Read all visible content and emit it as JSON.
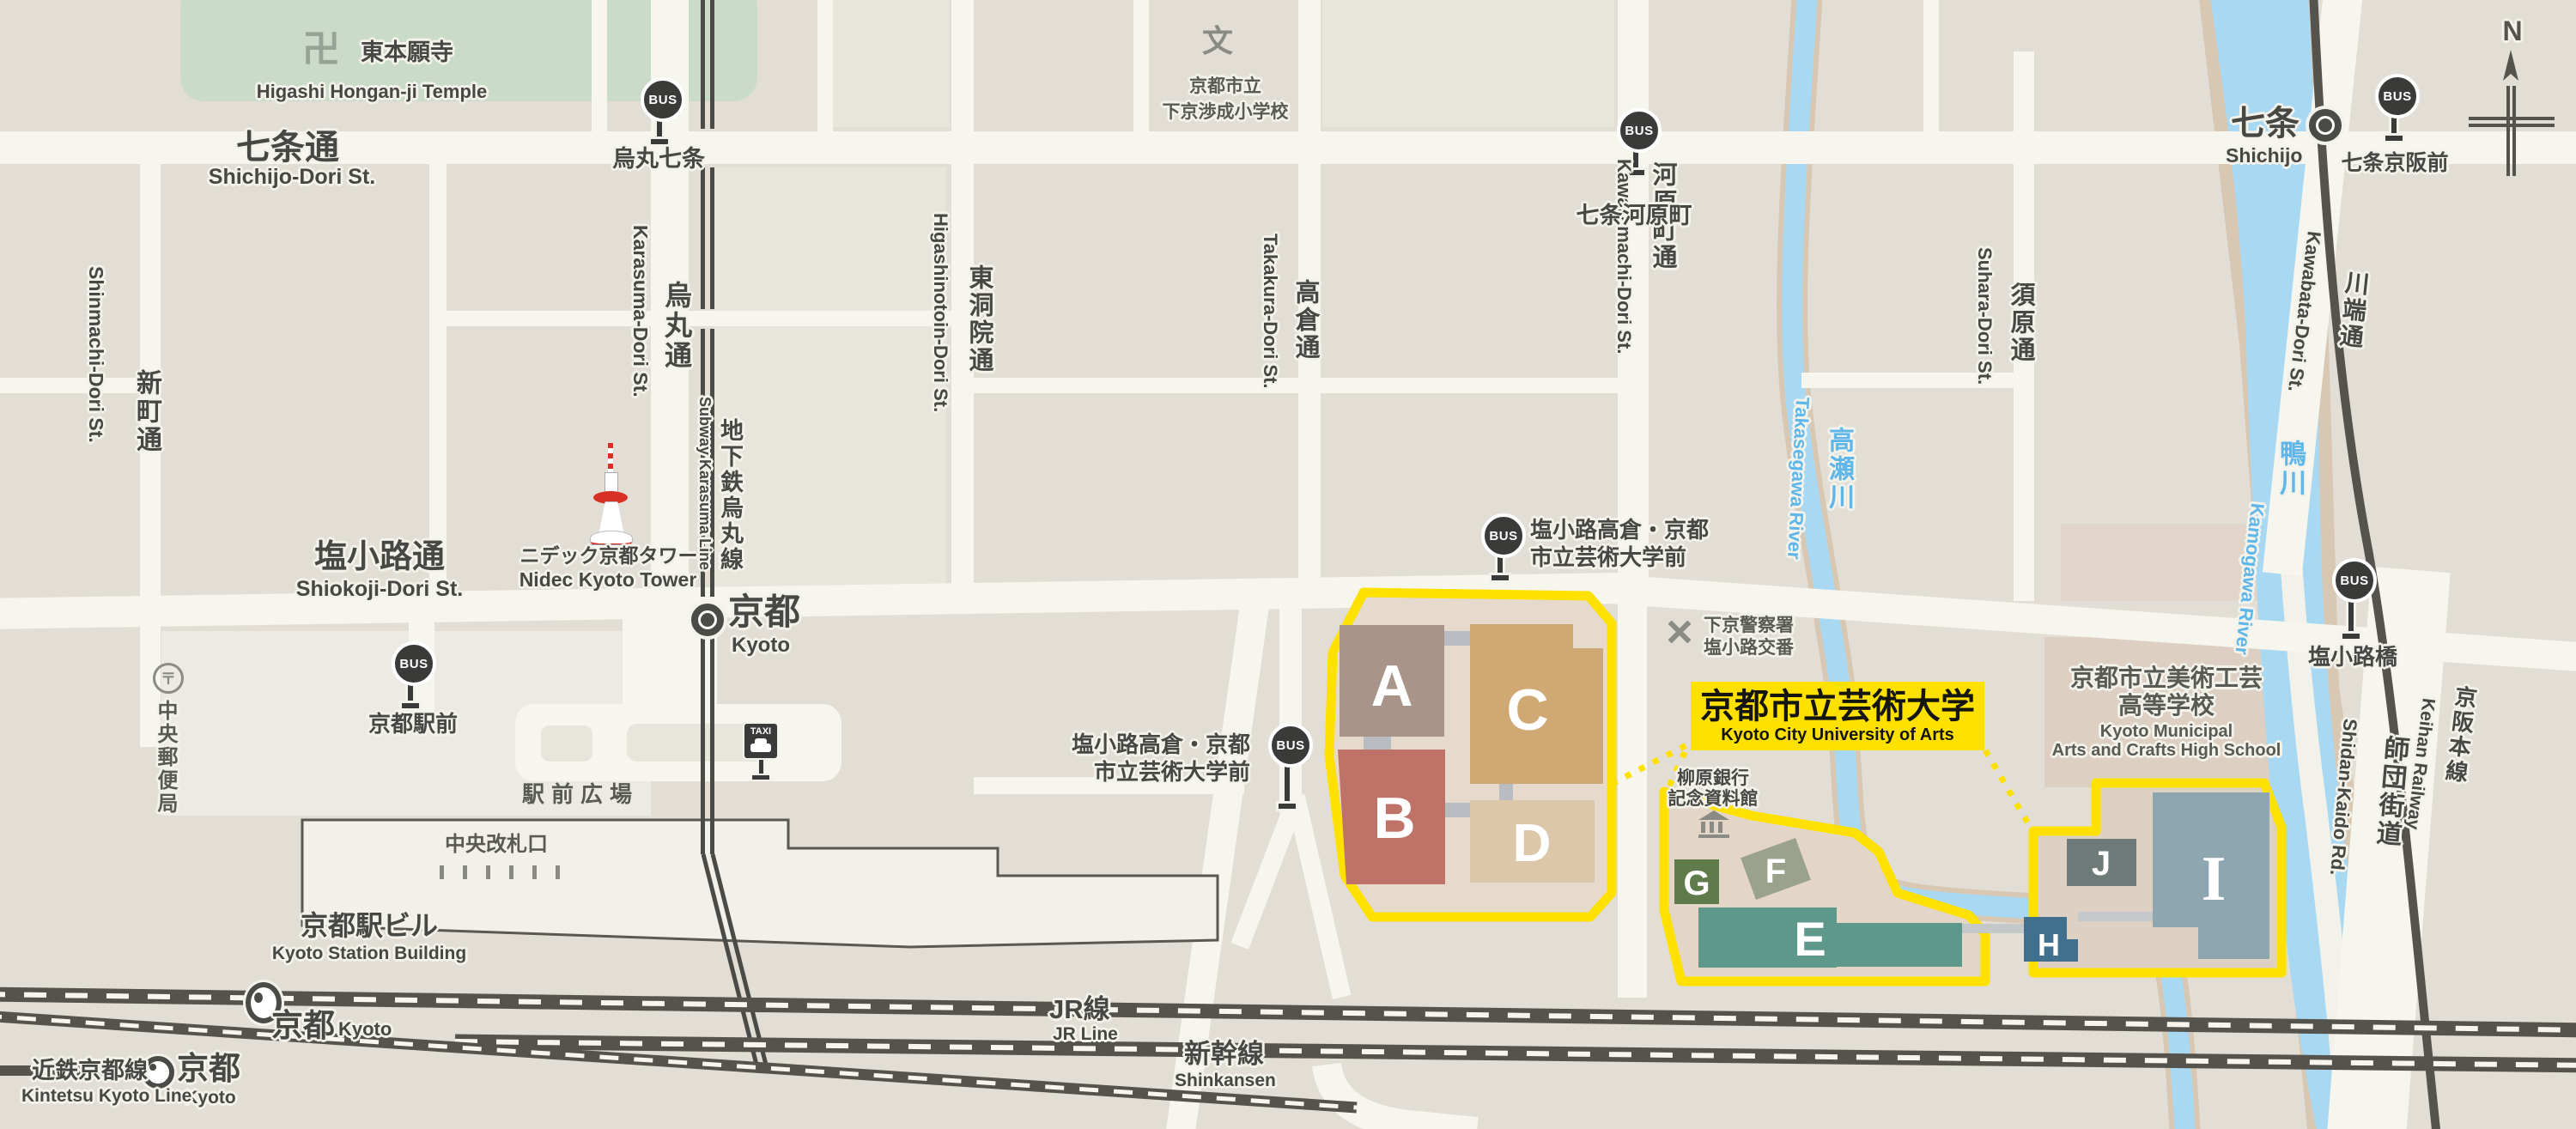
{
  "map": {
    "compass_n": "N",
    "bus_badge": "BUS",
    "taxi_badge": "TAXI"
  },
  "temple": {
    "icon": "卍",
    "ja": "東本願寺",
    "en": "Higashi Hongan-ji Temple"
  },
  "elementary_school": {
    "icon": "文",
    "ja1": "京都市立",
    "ja2": "下京渉成小学校"
  },
  "streets": {
    "shichijo": {
      "ja": "七条通",
      "en": "Shichijo-Dori St."
    },
    "shiokoji": {
      "ja": "塩小路通",
      "en": "Shiokoji-Dori St."
    },
    "shinmachi": {
      "ja": "新町通",
      "en": "Shinmachi-Dori St."
    },
    "karasuma": {
      "ja": "烏丸通",
      "en": "Karasuma-Dori St."
    },
    "higashinotoin": {
      "ja": "東洞院通",
      "en": "Higashinotoin-Dori St."
    },
    "takakura": {
      "ja": "高倉通",
      "en": "Takakura-Dori St."
    },
    "kawaramachi": {
      "ja": "河原町通",
      "en": "Kawaramachi-Dori St."
    },
    "suhara": {
      "ja": "須原通",
      "en": "Suhara-Dori St."
    },
    "kawabata": {
      "ja": "川端通",
      "en": "Kawabata-Dori St."
    },
    "shidankaido": {
      "ja": "師団街道",
      "en": "Shidan-Kaido Rd."
    }
  },
  "railways": {
    "subway": {
      "ja": "地下鉄烏丸線",
      "en": "Subway Karasuma Line"
    },
    "jr": {
      "ja": "JR線",
      "en": "JR Line"
    },
    "shinkansen": {
      "ja": "新幹線",
      "en": "Shinkansen"
    },
    "kintetsu": {
      "ja": "近鉄京都線",
      "en": "Kintetsu Kyoto Line"
    },
    "keihan": {
      "ja": "京阪本線",
      "en": "Keihan Railway"
    }
  },
  "rivers": {
    "takasegawa": {
      "ja": "高瀬川",
      "en": "Takasegawa River"
    },
    "kamogawa": {
      "ja": "鴨川",
      "en": "Kamogawa River"
    }
  },
  "stations": {
    "kyoto_subway": {
      "ja": "京都",
      "en": "Kyoto"
    },
    "kyoto_jr": {
      "ja": "京都",
      "en": "Kyoto"
    },
    "kyoto_kintetsu": {
      "ja": "京都",
      "en": "Kyoto"
    },
    "shichijo": {
      "ja": "七条",
      "en": "Shichijo"
    }
  },
  "bus_stops": {
    "karasuma_shichijo": "烏丸七条",
    "shichijo_kawaramachi": "七条河原町",
    "kyoto_ekimae": "京都駅前",
    "shiokoji_takakura_1": "塩小路高倉・京都",
    "shiokoji_takakura_2": "市立芸術大学前",
    "shiokojibashi": "塩小路橋",
    "shichijo_keihan_mae": "七条京阪前"
  },
  "landmarks": {
    "tower": {
      "ja": "ニデック京都タワー",
      "en": "Nidec Kyoto Tower"
    },
    "station_building": {
      "ja": "京都駅ビル",
      "en": "Kyoto Station Building"
    },
    "plaza": "駅前広場",
    "central_gate": "中央改札口",
    "post_office": {
      "icon": "〒",
      "ja": "中央郵便局"
    },
    "police": {
      "ja1": "下京警察署",
      "ja2": "塩小路交番"
    },
    "museum": {
      "ja1": "柳原銀行",
      "ja2": "記念資料館"
    },
    "highschool": {
      "ja1": "京都市立美術工芸",
      "ja2": "高等学校",
      "en1": "Kyoto Municipal",
      "en2": "Arts and Crafts High School"
    }
  },
  "university": {
    "ja": "京都市立芸術大学",
    "en": "Kyoto City University of Arts"
  },
  "buildings": {
    "a": "A",
    "b": "B",
    "c": "C",
    "d": "D",
    "e": "E",
    "f": "F",
    "g": "G",
    "h": "H",
    "i": "I",
    "j": "J"
  }
}
